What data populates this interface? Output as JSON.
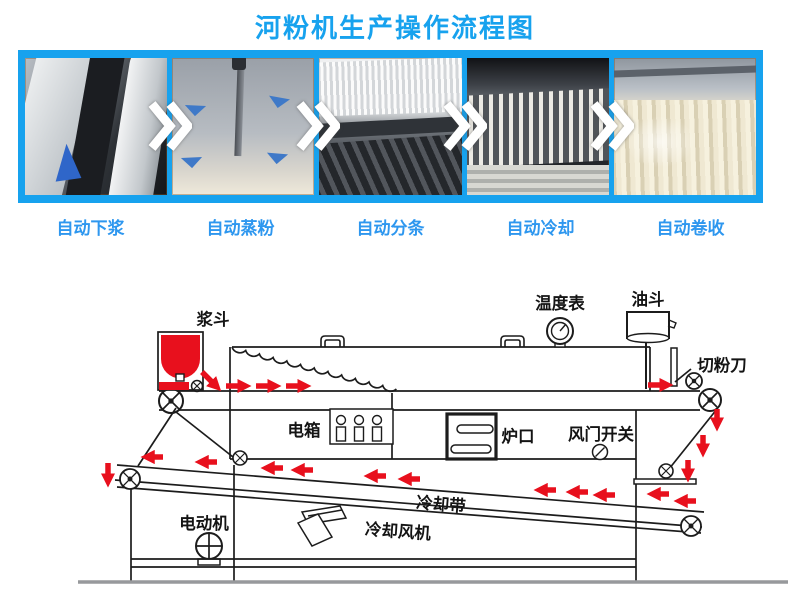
{
  "title": "河粉机生产操作流程图",
  "colors": {
    "accent_blue": "#17a2ee",
    "text_blue": "#2e97ef",
    "arrow_red": "#e8101d"
  },
  "process_steps": [
    {
      "label": "自动下浆"
    },
    {
      "label": "自动蒸粉"
    },
    {
      "label": "自动分条"
    },
    {
      "label": "自动冷却"
    },
    {
      "label": "自动卷收"
    }
  ],
  "diagram": {
    "labels": {
      "slurry_hopper": "浆斗",
      "temperature_gauge": "温度表",
      "oil_hopper": "油斗",
      "noodle_cutter": "切粉刀",
      "electric_box": "电箱",
      "furnace_mouth": "炉口",
      "damper_switch": "风门开关",
      "cooling_belt": "冷却带",
      "cooling_fan": "冷却风机",
      "electric_motor": "电动机"
    }
  }
}
